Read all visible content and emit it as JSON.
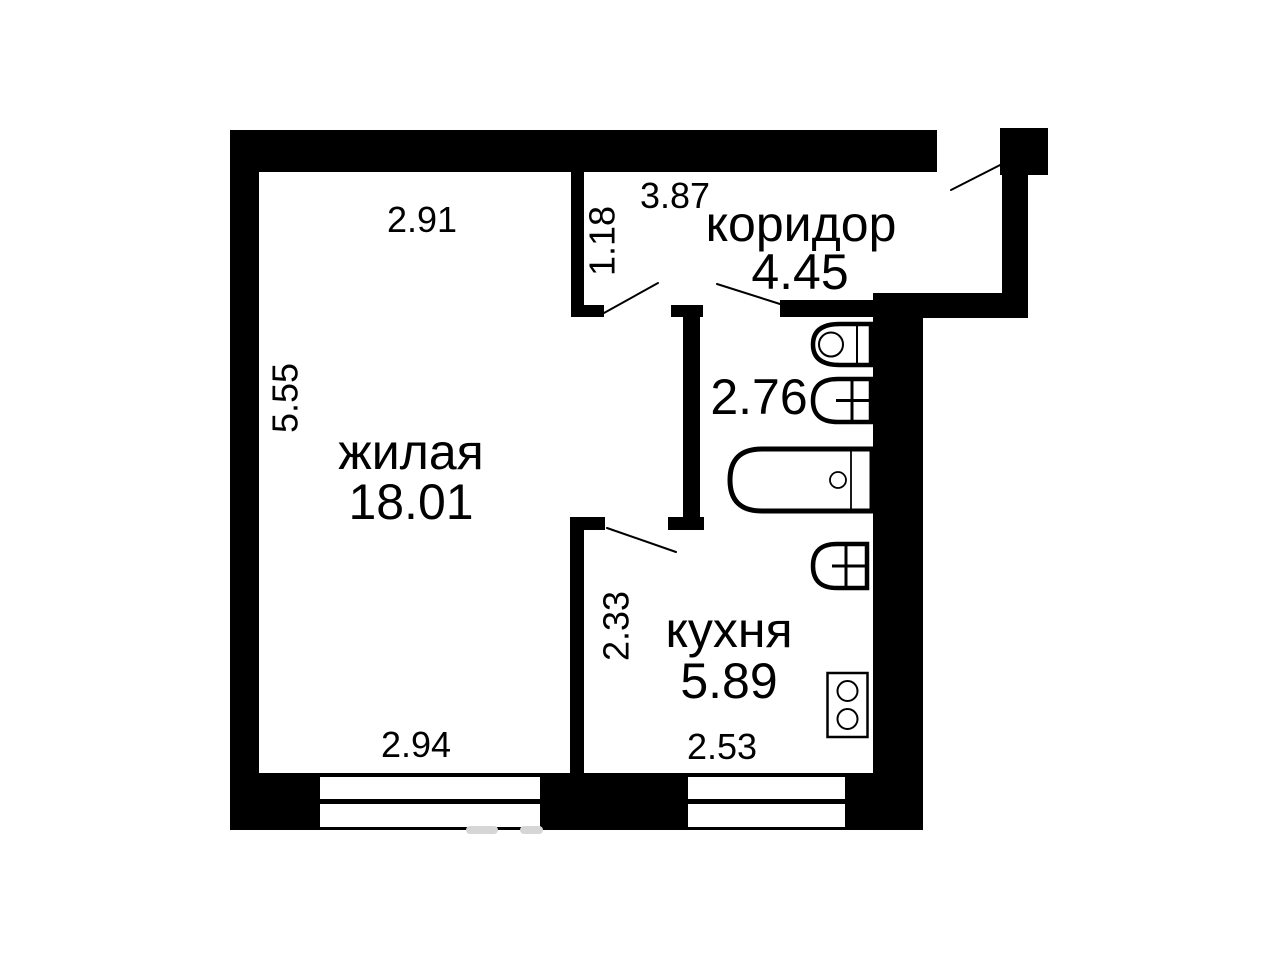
{
  "plan": {
    "title": "floor-plan",
    "rooms": [
      {
        "key": "living",
        "label": "жилая",
        "area": "18.01"
      },
      {
        "key": "corridor",
        "label": "коридор",
        "area": "4.45"
      },
      {
        "key": "kitchen",
        "label": "кухня",
        "area": "5.89"
      },
      {
        "key": "bathroom",
        "label": "",
        "area": "2.76"
      }
    ],
    "dimensions": {
      "living_top": "2.91",
      "living_left": "5.55",
      "living_bottom": "2.94",
      "corridor_top": "3.87",
      "corridor_left": "1.18",
      "kitchen_left": "2.33",
      "kitchen_bottom": "2.53"
    },
    "fixtures": [
      "toilet-icon",
      "sink-icon",
      "bathtub-icon",
      "kitchen-sink-icon",
      "stove-icon"
    ],
    "colors": {
      "wall": "#000000",
      "background": "#ffffff",
      "line": "#000000",
      "watermark": "#d6d6d6"
    }
  }
}
